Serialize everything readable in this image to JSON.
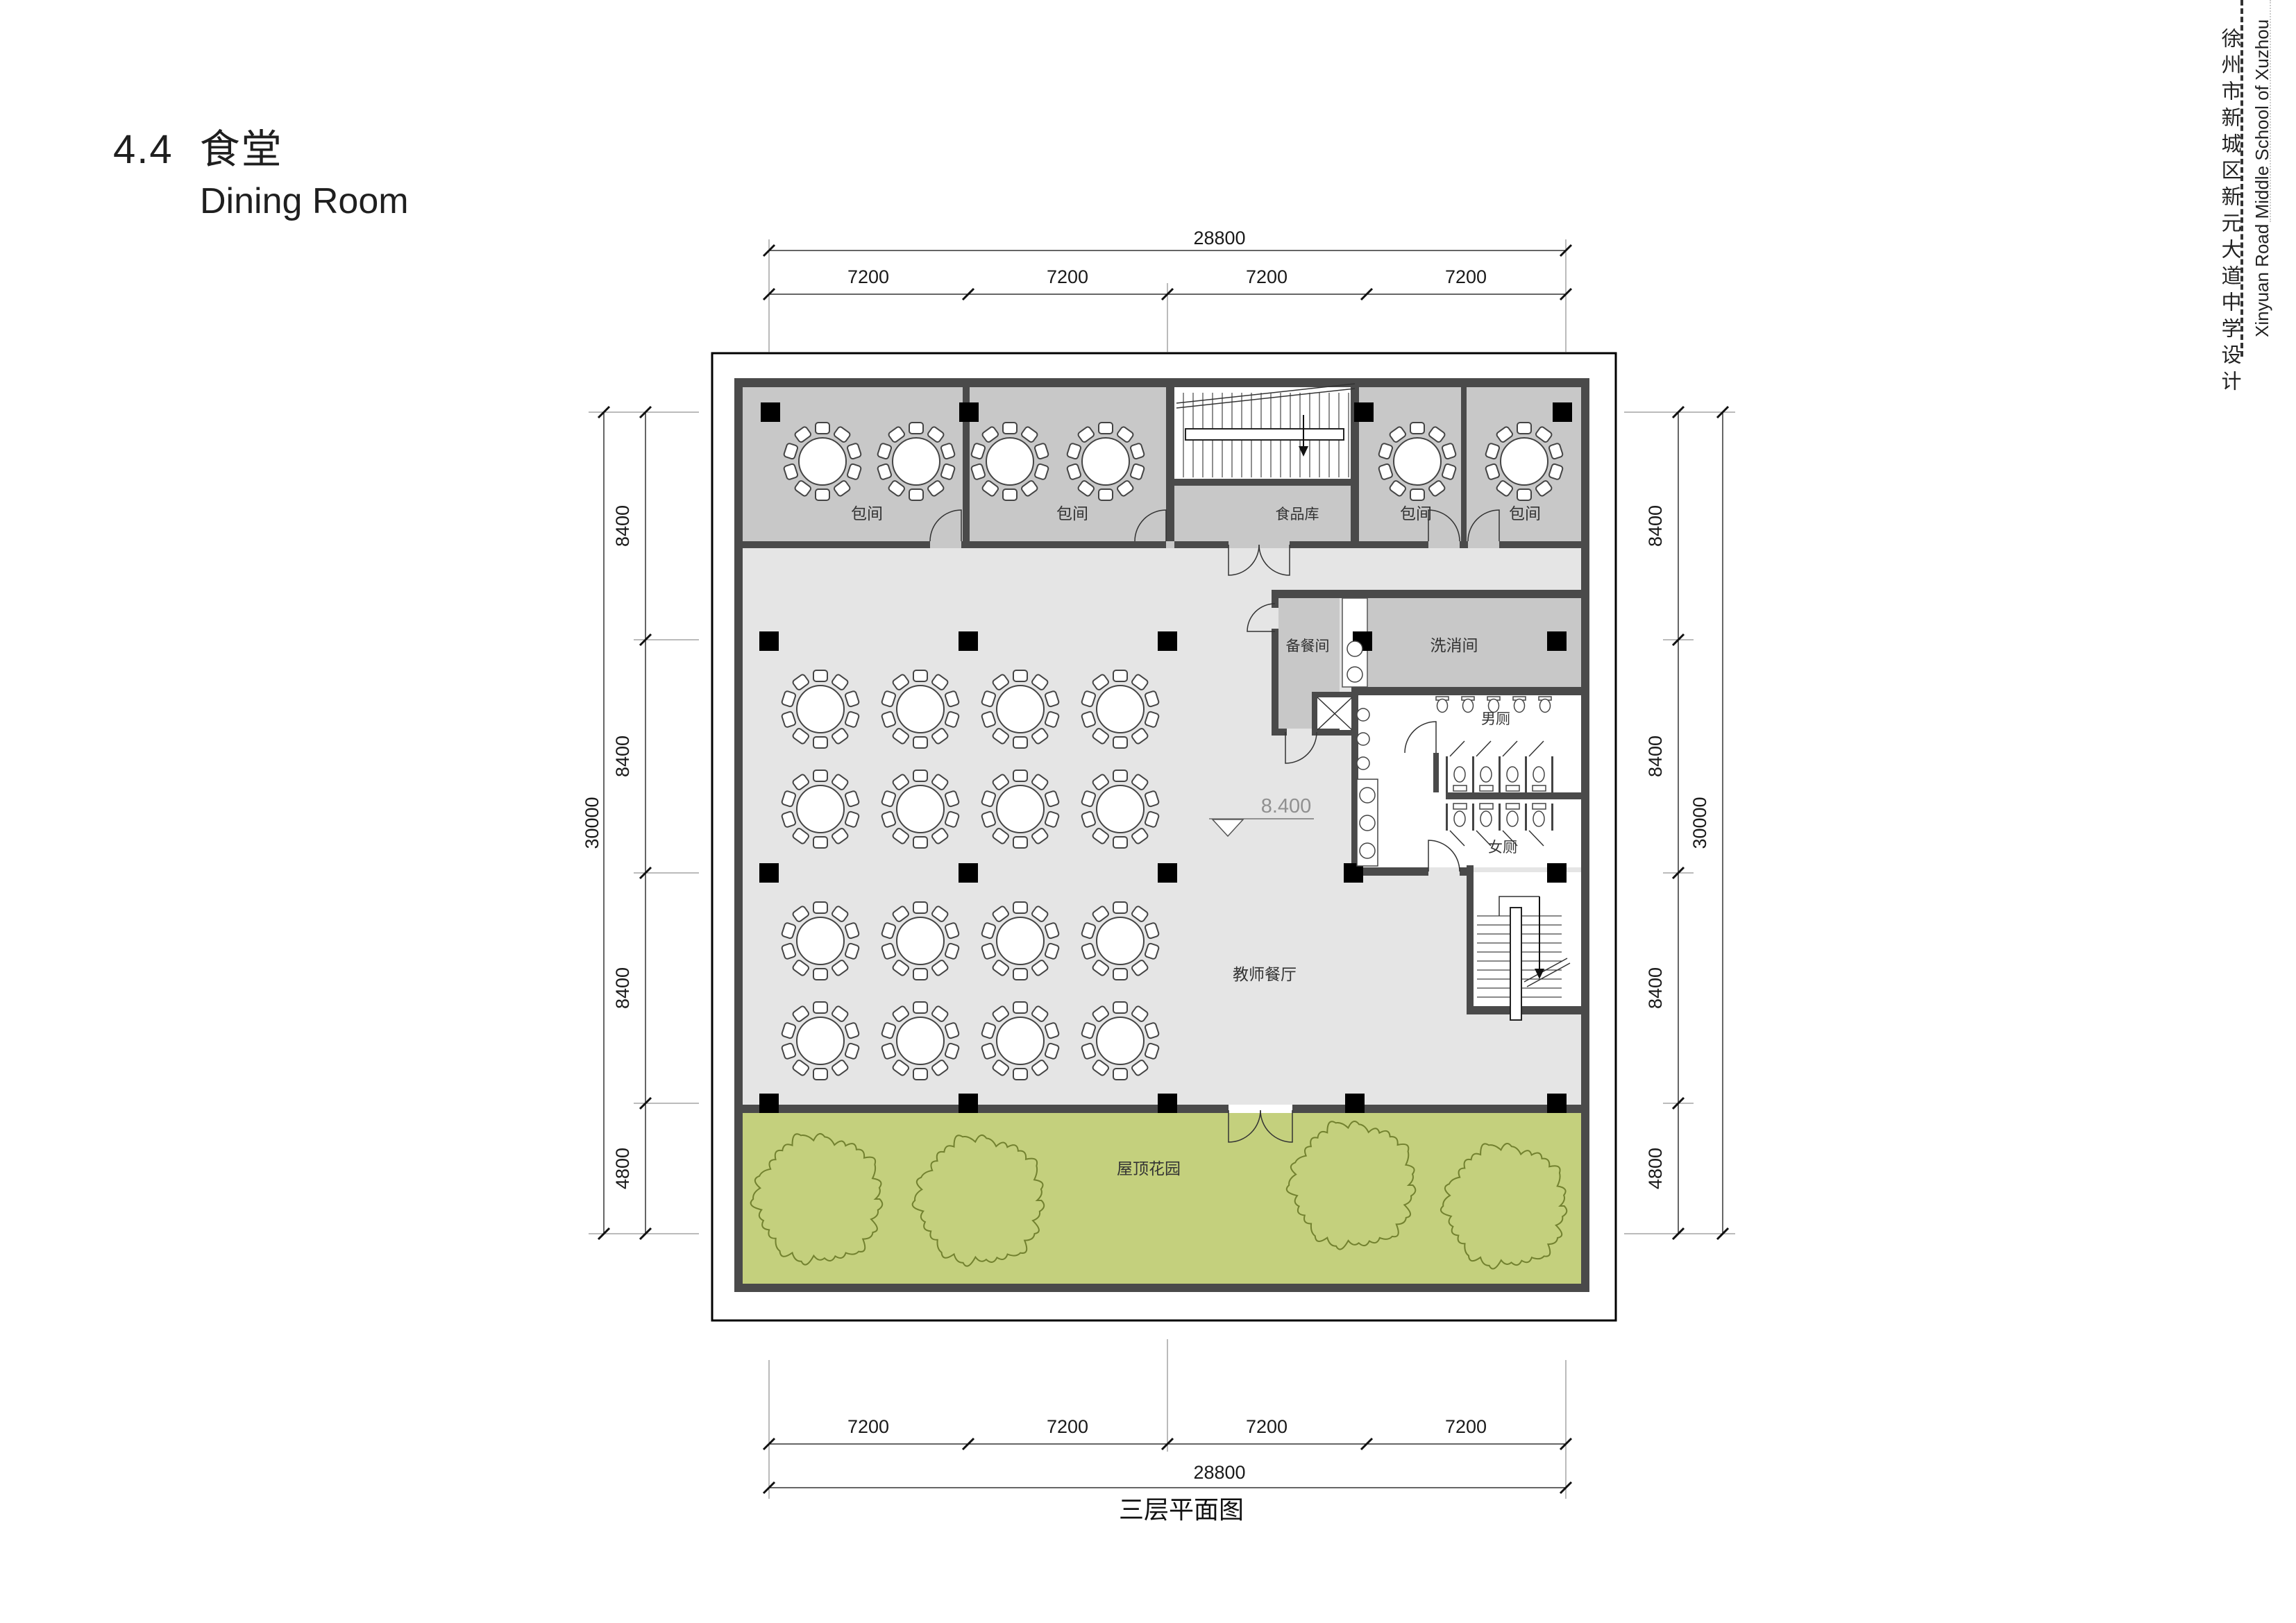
{
  "page": {
    "title_number": "4.4",
    "title_zh": "食堂",
    "title_en": "Dining Room",
    "caption": "三层平面图"
  },
  "side": {
    "zh": "徐州市新城区新元大道中学设计",
    "en": "Xinyuan Road Middle School of Xuzhou"
  },
  "plan": {
    "elevation": "8.400",
    "rooms": {
      "private_room": "包间",
      "food_storage": "食品库",
      "prep_room": "备餐间",
      "washing_room": "洗消间",
      "male_toilet": "男厕",
      "female_toilet": "女厕",
      "teachers_dining": "教师餐厅",
      "roof_garden": "屋顶花园"
    }
  },
  "dims": {
    "h": {
      "total": "28800",
      "segs": [
        "7200",
        "7200",
        "7200",
        "7200"
      ]
    },
    "v": {
      "total": "30000",
      "segs": [
        "8400",
        "8400",
        "8400",
        "4800"
      ]
    }
  },
  "colors": {
    "wall": "#4a4a4a",
    "room_gray": "#c8c8c8",
    "hall_gray": "#e5e5e5",
    "garden_green": "#c4d07d",
    "tree_stroke": "#72812f",
    "dim_line": "#333333",
    "elevation_text": "#909090"
  }
}
